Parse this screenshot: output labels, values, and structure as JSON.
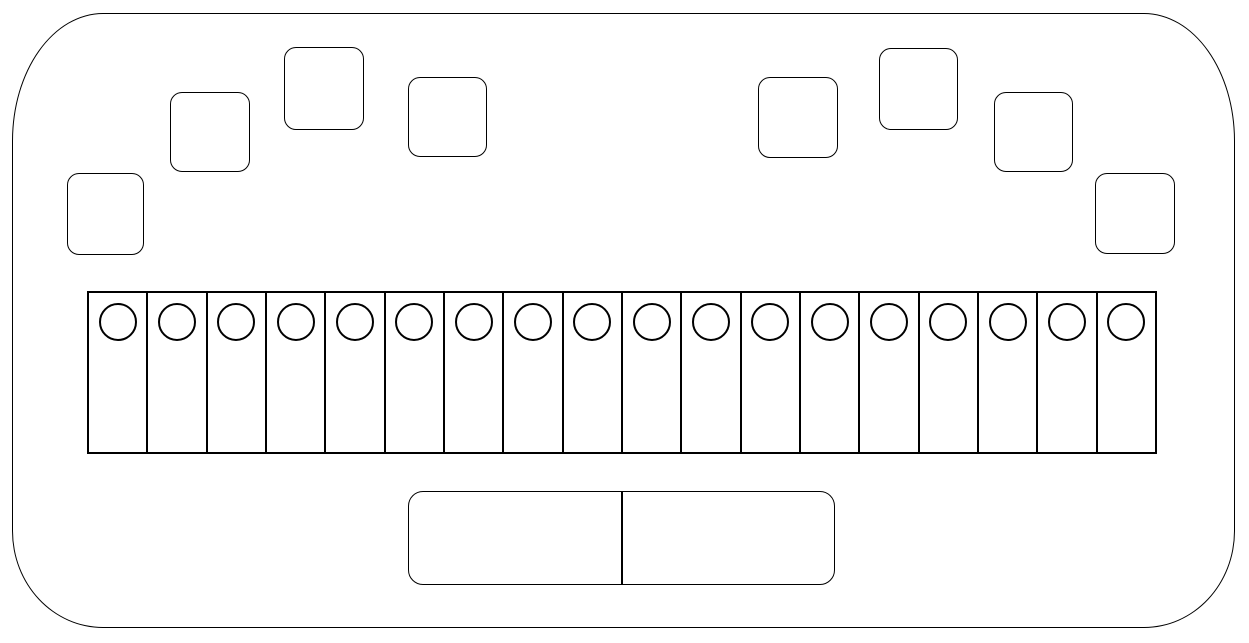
{
  "diagram": {
    "kind": "keyboard-device-line-drawing",
    "canvas": {
      "width": 1249,
      "height": 643,
      "background": "#ffffff",
      "stroke": "#000000"
    },
    "device_body": {
      "x": 12,
      "y": 13,
      "width": 1223,
      "height": 615,
      "corner_radius_x": 91,
      "corner_radius_y_top": 128,
      "corner_radius_y_bottom": 97
    },
    "top_pads": {
      "count": 8,
      "shape": "rounded-square",
      "corner_radius": 12,
      "items": [
        {
          "id": "pad-1",
          "x": 67,
          "y": 173,
          "width": 77,
          "height": 82
        },
        {
          "id": "pad-2",
          "x": 170,
          "y": 92,
          "width": 80,
          "height": 80
        },
        {
          "id": "pad-3",
          "x": 284,
          "y": 47,
          "width": 80,
          "height": 83
        },
        {
          "id": "pad-4",
          "x": 408,
          "y": 77,
          "width": 79,
          "height": 80
        },
        {
          "id": "pad-5",
          "x": 758,
          "y": 77,
          "width": 80,
          "height": 81
        },
        {
          "id": "pad-6",
          "x": 879,
          "y": 48,
          "width": 79,
          "height": 82
        },
        {
          "id": "pad-7",
          "x": 994,
          "y": 92,
          "width": 79,
          "height": 80
        },
        {
          "id": "pad-8",
          "x": 1095,
          "y": 173,
          "width": 80,
          "height": 81
        }
      ]
    },
    "key_row": {
      "x": 87,
      "y": 291,
      "width": 1070,
      "height": 163,
      "key_count": 18,
      "circle_diameter": 38,
      "circle_top_offset": 10
    },
    "space_bar": {
      "x": 408,
      "y": 491,
      "width": 427,
      "height": 94,
      "segment_count": 2,
      "corner_radius": 15
    }
  }
}
